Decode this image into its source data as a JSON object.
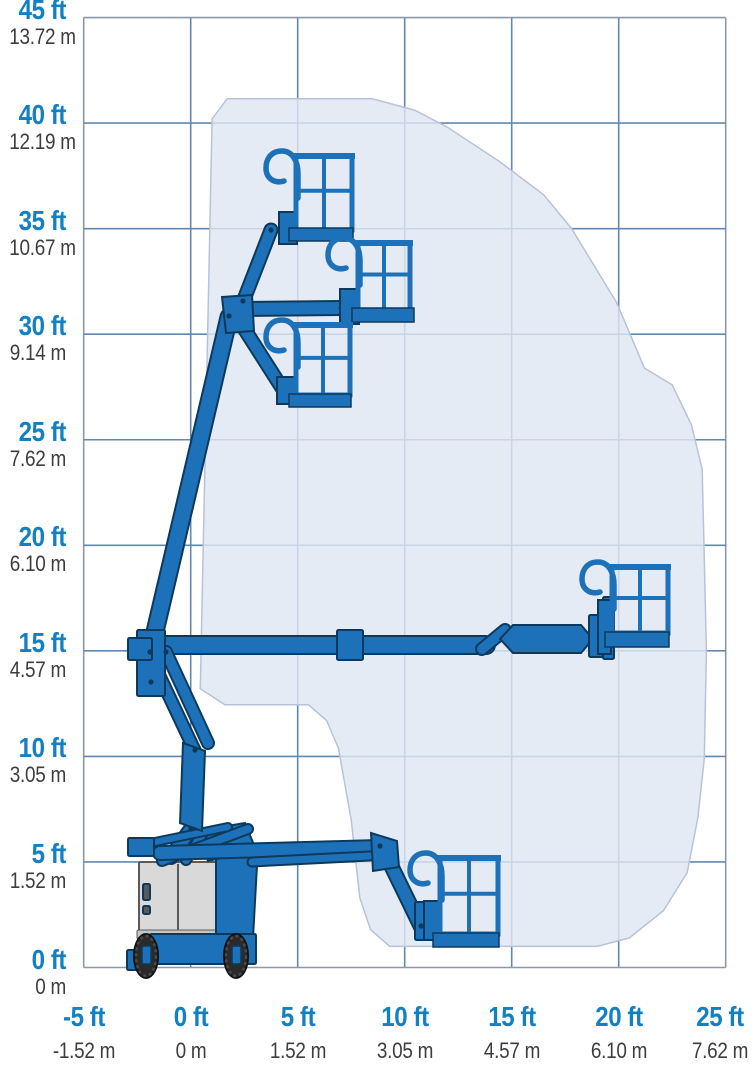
{
  "chart_data": {
    "type": "area",
    "title": "",
    "xlabel": "",
    "ylabel": "",
    "grid": true,
    "legend": "none",
    "description": "Articulated boom lift working envelope (range of motion) diagram with machine shown in five platform positions",
    "x_axis": {
      "range_ft": [
        -5,
        25
      ],
      "ticks": [
        {
          "value": -5,
          "ft": "-5 ft",
          "m": "-1.52 m"
        },
        {
          "value": 0,
          "ft": "0 ft",
          "m": "0 m"
        },
        {
          "value": 5,
          "ft": "5 ft",
          "m": "1.52 m"
        },
        {
          "value": 10,
          "ft": "10 ft",
          "m": "3.05 m"
        },
        {
          "value": 15,
          "ft": "15 ft",
          "m": "4.57 m"
        },
        {
          "value": 20,
          "ft": "20 ft",
          "m": "6.10 m"
        },
        {
          "value": 25,
          "ft": "25 ft",
          "m": "7.62 m"
        }
      ]
    },
    "y_axis": {
      "range_ft": [
        0,
        45
      ],
      "ticks": [
        {
          "value": 0,
          "ft": "0 ft",
          "m": "0 m"
        },
        {
          "value": 5,
          "ft": "5 ft",
          "m": "1.52 m"
        },
        {
          "value": 10,
          "ft": "10 ft",
          "m": "3.05 m"
        },
        {
          "value": 15,
          "ft": "15 ft",
          "m": "4.57 m"
        },
        {
          "value": 20,
          "ft": "20 ft",
          "m": "6.10 m"
        },
        {
          "value": 25,
          "ft": "25 ft",
          "m": "7.62 m"
        },
        {
          "value": 30,
          "ft": "30 ft",
          "m": "9.14 m"
        },
        {
          "value": 35,
          "ft": "35 ft",
          "m": "10.67 m"
        },
        {
          "value": 40,
          "ft": "40 ft",
          "m": "12.19 m"
        },
        {
          "value": 45,
          "ft": "45 ft",
          "m": "13.72 m"
        }
      ]
    },
    "envelope_outline_ft": [
      [
        0.45,
        13.2
      ],
      [
        1.0,
        40.2
      ],
      [
        1.7,
        41.15
      ],
      [
        8.5,
        41.15
      ],
      [
        10.5,
        40.6
      ],
      [
        12.0,
        39.8
      ],
      [
        14.4,
        38.2
      ],
      [
        16.5,
        36.6
      ],
      [
        17.8,
        35.0
      ],
      [
        19.9,
        31.5
      ],
      [
        21.2,
        28.4
      ],
      [
        22.5,
        27.6
      ],
      [
        23.4,
        25.7
      ],
      [
        23.9,
        23.6
      ],
      [
        24.1,
        15.0
      ],
      [
        24.0,
        9.9
      ],
      [
        23.7,
        7.1
      ],
      [
        23.2,
        4.5
      ],
      [
        22.1,
        2.7
      ],
      [
        20.5,
        1.4
      ],
      [
        19.0,
        1.0
      ],
      [
        9.3,
        1.0
      ],
      [
        8.4,
        1.8
      ],
      [
        7.9,
        3.3
      ],
      [
        7.5,
        7.0
      ],
      [
        6.9,
        10.4
      ],
      [
        6.35,
        11.7
      ],
      [
        5.5,
        12.45
      ],
      [
        1.6,
        12.45
      ]
    ],
    "platform_positions_ft": [
      {
        "name": "max-height",
        "x": 6.2,
        "y": 34.7
      },
      {
        "name": "high-mid",
        "x": 9.0,
        "y": 30.9
      },
      {
        "name": "high-low",
        "x": 6.2,
        "y": 26.9
      },
      {
        "name": "max-horizontal",
        "x": 21.0,
        "y": 15.5
      },
      {
        "name": "low-forward",
        "x": 13.0,
        "y": 1.3
      }
    ],
    "layout": {
      "plot_left_px": 83.7,
      "plot_right_px": 725.7,
      "plot_top_px": 17.5,
      "plot_bottom_px": 967.5,
      "x0_px": 190.7,
      "px_per_ft_x": 21.4,
      "y0_px": 967.5,
      "px_per_ft_y": 21.11
    }
  },
  "colors": {
    "background": "#ffffff",
    "grid": "#6288b0",
    "border": "#8a98a8",
    "envelope_fill": "#dfe6f3",
    "envelope_stroke": "#b7c3d8",
    "label_blue": "#1280c2",
    "label_gray": "#3d3d3d",
    "machine_blue": "#1d71b8",
    "machine_dark": "#0d3a5c",
    "hood_gray": "#d9d9d9",
    "hood_gray2": "#c4c4c4",
    "hood_stroke": "#5a5a5a",
    "wheel_dark": "#2a2a2a"
  },
  "machine": {
    "base_shapes": [
      {
        "type": "rect",
        "x": 139,
        "y": 862,
        "w": 78,
        "h": 74,
        "fill": "hood_gray",
        "stroke": "hood_stroke",
        "sw": 2
      },
      {
        "type": "line",
        "x1": 178,
        "y1": 864,
        "x2": 178,
        "y2": 934,
        "color": "hood_stroke",
        "w": 2
      },
      {
        "type": "rect",
        "x": 143,
        "y": 884,
        "w": 7,
        "h": 16,
        "fill": "hood_stroke"
      },
      {
        "type": "rect",
        "x": 143,
        "y": 906,
        "w": 7,
        "h": 8,
        "fill": "hood_stroke"
      },
      {
        "type": "rect",
        "x": 137,
        "y": 930,
        "w": 82,
        "h": 9,
        "fill": "hood_gray2",
        "stroke": "hood_stroke",
        "sw": 1
      },
      {
        "type": "poly",
        "pts": [
          [
            216,
            839
          ],
          [
            258,
            847
          ],
          [
            253,
            938
          ],
          [
            216,
            938
          ]
        ]
      },
      {
        "type": "rect",
        "x": 150,
        "y": 934,
        "w": 106,
        "h": 30
      },
      {
        "type": "rect",
        "x": 127,
        "y": 950,
        "w": 28,
        "h": 20
      },
      {
        "type": "poly",
        "pts": [
          [
            197,
            831
          ],
          [
            245,
            823
          ],
          [
            256,
            850
          ],
          [
            208,
            861
          ]
        ]
      }
    ],
    "wheels": [
      {
        "cx": 146,
        "cy": 956,
        "rx": 12,
        "ry": 22
      },
      {
        "cx": 236,
        "cy": 956,
        "rx": 12,
        "ry": 22
      }
    ],
    "hubs": [
      {
        "x": 142,
        "y": 946,
        "w": 9,
        "h": 18
      },
      {
        "x": 232,
        "y": 946,
        "w": 9,
        "h": 18
      }
    ],
    "arms": [
      [
        151,
        645,
        486,
        645,
        16
      ],
      [
        150,
        653,
        229,
        317,
        15
      ],
      [
        243,
        302,
        271,
        230,
        11
      ],
      [
        239,
        309,
        341,
        308,
        12
      ],
      [
        238,
        319,
        282,
        388,
        11
      ],
      [
        482,
        649,
        505,
        630,
        10
      ],
      [
        152,
        660,
        195,
        751,
        10
      ],
      [
        166,
        652,
        208,
        743,
        10
      ],
      [
        191,
        829,
        171,
        857,
        12
      ],
      [
        203,
        833,
        186,
        860,
        8
      ],
      [
        162,
        861,
        248,
        829,
        8
      ],
      [
        150,
        843,
        228,
        827,
        6
      ],
      [
        160,
        853,
        380,
        847,
        12
      ],
      [
        252,
        862,
        370,
        856,
        7
      ],
      [
        387,
        857,
        421,
        927,
        12
      ]
    ],
    "polys": [
      {
        "name": "upper-knuckle",
        "pts": [
          [
            222,
            297
          ],
          [
            252,
            295
          ],
          [
            254,
            331
          ],
          [
            226,
            333
          ]
        ]
      },
      {
        "name": "jib-arm-horizontal",
        "pts": [
          [
            500,
            639
          ],
          [
            513,
            625
          ],
          [
            581,
            625
          ],
          [
            593,
            639
          ],
          [
            581,
            653
          ],
          [
            513,
            653
          ]
        ]
      },
      {
        "name": "low-knuckle",
        "pts": [
          [
            371,
            833
          ],
          [
            397,
            841
          ],
          [
            399,
            867
          ],
          [
            373,
            871
          ]
        ]
      },
      {
        "name": "riser-plate",
        "pts": [
          [
            183,
            743
          ],
          [
            205,
            751
          ],
          [
            202,
            831
          ],
          [
            180,
            823
          ]
        ]
      }
    ],
    "rects": [
      {
        "name": "pivot-plate",
        "x": 137,
        "y": 630,
        "w": 28,
        "h": 66
      },
      {
        "name": "boom-tail-up",
        "x": 128,
        "y": 638,
        "w": 24,
        "h": 22
      },
      {
        "name": "boom-tail-low",
        "x": 128,
        "y": 838,
        "w": 26,
        "h": 18
      },
      {
        "name": "telescope-collar",
        "x": 337,
        "y": 630,
        "w": 26,
        "h": 30
      },
      {
        "name": "wrist-e1",
        "x": 589,
        "y": 615,
        "w": 14,
        "h": 42
      },
      {
        "name": "wrist-e2",
        "x": 603,
        "y": 597,
        "w": 11,
        "h": 62
      },
      {
        "name": "wrist-d",
        "x": 415,
        "y": 902,
        "w": 18,
        "h": 38
      }
    ],
    "bolts": [
      [
        150,
        652
      ],
      [
        151,
        682
      ],
      [
        229,
        316
      ],
      [
        243,
        301
      ],
      [
        271,
        230
      ],
      [
        341,
        308
      ],
      [
        282,
        388
      ],
      [
        195,
        750
      ],
      [
        166,
        652
      ],
      [
        191,
        829
      ],
      [
        380,
        846
      ],
      [
        421,
        926
      ]
    ],
    "baskets": [
      {
        "name": "platform-max-height",
        "rx": 296,
        "ry": 156,
        "rw": 56,
        "rh": 74,
        "fx": 289,
        "fy": 228,
        "fw": 64,
        "fh": 13,
        "cx": 298,
        "cy": 158,
        "mx": 279,
        "my": 212,
        "mw": 18,
        "mh": 32
      },
      {
        "name": "platform-high-mid",
        "rx": 358,
        "ry": 243,
        "rw": 52,
        "rh": 67,
        "fx": 352,
        "fy": 308,
        "fw": 62,
        "fh": 14,
        "cx": 360,
        "cy": 245,
        "mx": 340,
        "my": 289,
        "mw": 19,
        "mh": 35
      },
      {
        "name": "platform-high-low",
        "rx": 296,
        "ry": 325,
        "rw": 54,
        "rh": 70,
        "fx": 289,
        "fy": 394,
        "fw": 62,
        "fh": 13,
        "cx": 298,
        "cy": 327,
        "mx": 277,
        "my": 377,
        "mw": 20,
        "mh": 27
      },
      {
        "name": "platform-low-forward",
        "rx": 440,
        "ry": 858,
        "rw": 58,
        "rh": 76,
        "fx": 433,
        "fy": 933,
        "fw": 66,
        "fh": 14,
        "cx": 442,
        "cy": 860,
        "mx": 424,
        "my": 901,
        "mw": 17,
        "mh": 39
      },
      {
        "name": "platform-max-horizontal",
        "rx": 612,
        "ry": 567,
        "rw": 56,
        "rh": 66,
        "fx": 605,
        "fy": 632,
        "fw": 64,
        "fh": 15,
        "cx": 614,
        "cy": 569,
        "mx": 598,
        "my": 600,
        "mw": 13,
        "mh": 54
      }
    ]
  }
}
